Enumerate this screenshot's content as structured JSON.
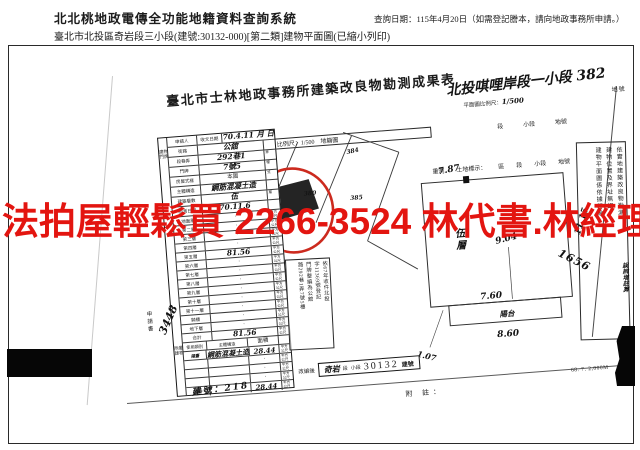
{
  "header": {
    "system_title": "北北桃地政電傳全功能地籍資料查詢系統",
    "query_date": "查詢日期：115年4月20日（如需登記謄本，請向地政事務所申請。）",
    "subtitle": "臺北市北投區奇岩段三小段(建號:30132-000)[第二類]建物平面圖(已縮小列印)"
  },
  "watermark": {
    "text": "法拍屋輕鬆買  2266-3524  林代書.林經理",
    "color": "#e31510",
    "circle_color": "#cc2a1e"
  },
  "document": {
    "title": "臺北市士林地政事務所建築改良物勘測成果表",
    "hw_section": "北投唭哩岸段一小段 382",
    "scale_label": "平面圖比例尺：",
    "scale_hw": "1/500",
    "parcel_no_label": "地號",
    "land_row1": [
      "段",
      "小段",
      "地號"
    ],
    "land_row2": [
      "重測",
      "土地標示：",
      "區",
      "段",
      "小段",
      "地號"
    ],
    "location_map": {
      "header": "位置圖　比例尺：1/500　地籍圖",
      "parcels": [
        "384",
        "380",
        "385"
      ]
    },
    "table": {
      "top_rows": [
        {
          "label": "申請人",
          "label2": "收文日期",
          "value": "70.4.11 月 日",
          "hw": true
        },
        {
          "label": "街路",
          "value": "公舘",
          "suffix": "",
          "hw": true
        },
        {
          "label": "段巷弄",
          "value": "292巷1",
          "suffix": "弄",
          "hw": true
        },
        {
          "label": "門牌",
          "value": "7號5",
          "suffix": "樓",
          "hw": true
        },
        {
          "label": "房屋式樣",
          "value": "本國",
          "suffix": "式",
          "hw": false
        },
        {
          "label": "主體構造",
          "value": "鋼筋混凝土造",
          "suffix": "",
          "hw": true
        },
        {
          "label": "建築層數",
          "value": "伍",
          "suffix": "層",
          "hw": true
        },
        {
          "label": "勘測日期",
          "value": "70.11.6",
          "suffix": "",
          "hw": true
        }
      ],
      "area_rows": [
        {
          "label": "地面層",
          "value": "·"
        },
        {
          "label": "第二層",
          "value": "·"
        },
        {
          "label": "第三層",
          "value": "·"
        },
        {
          "label": "第四層",
          "value": "·"
        },
        {
          "label": "第五層",
          "value": "81.56",
          "hw": true
        },
        {
          "label": "第六層",
          "value": "·"
        },
        {
          "label": "第七層",
          "value": "·"
        },
        {
          "label": "第八層",
          "value": "·"
        },
        {
          "label": "第九層",
          "value": "·"
        },
        {
          "label": "第十層",
          "value": "·"
        },
        {
          "label": "第十一層",
          "value": "·"
        },
        {
          "label": "騎樓",
          "value": "·"
        },
        {
          "label": "地下層",
          "value": "·"
        },
        {
          "label": "合計",
          "value": "81.56",
          "hw": true
        }
      ],
      "unit": "平方公尺",
      "door_group_label": "建物門牌",
      "annex_label": "附屬建物",
      "annex_header": [
        "使用類別",
        "主體構造",
        "面積"
      ],
      "annex_rows": [
        {
          "use": "陽臺",
          "struct": "鋼筋混凝土造",
          "area": "28.44",
          "hw": true
        },
        {
          "use": "",
          "struct": "",
          "area": "·"
        },
        {
          "use": "",
          "struct": "",
          "area": "·"
        },
        {
          "use": "",
          "struct": "",
          "area": "·"
        },
        {
          "use": "合計",
          "struct": "",
          "area": "28.44",
          "hw": true
        }
      ],
      "side_label": "申請書",
      "hw_file_no": "3448"
    },
    "floor_plan": {
      "dim_top": "7.87",
      "dim_mid": "9.04",
      "dim_right": "11.15",
      "dim_bottom": "7.60",
      "balcony_label": "陽台",
      "dim_balcony": "8.60",
      "dim_offset": "1.07",
      "floor_char1": "伍",
      "floor_char2": "層"
    },
    "cert_box": {
      "cols": [
        "依實地建築改良物勘測",
        "建物位置及界址無誤",
        "建物平面圖係依據轉繪"
      ],
      "hw_no": "1656",
      "hw_note": "誤辨增註算"
    },
    "doorplate_stamp": {
      "cols": [
        "依67年收件北投",
        "字11369號登記",
        "門牌整編為公舘",
        "路292巷1弄7號5樓"
      ]
    },
    "renumber_stamp": {
      "label": "改編後",
      "hw_seg": "奇岩",
      "seg": "段",
      "small": "小段",
      "number": "30132",
      "suffix": "建號"
    },
    "hw_building_no": "建號：218",
    "note_label": "附 註：",
    "print_code": "68. 7. 2,000M"
  }
}
